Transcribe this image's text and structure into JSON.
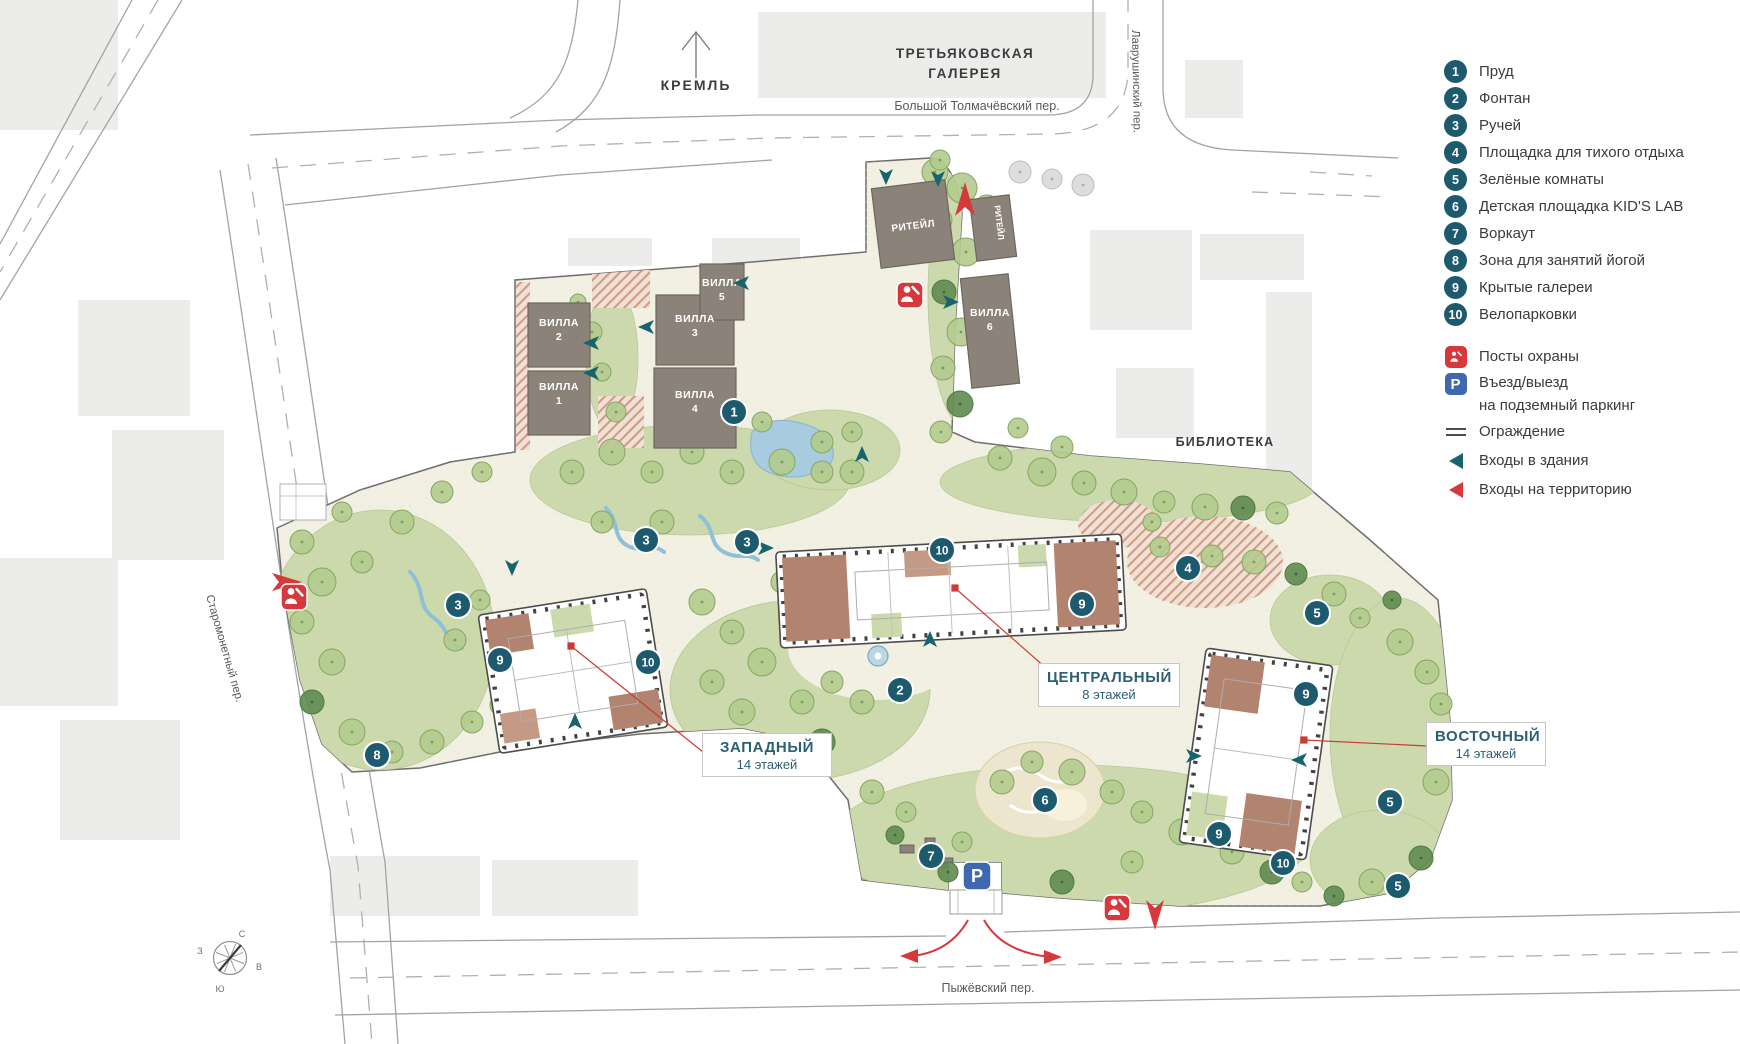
{
  "map": {
    "landmarks": {
      "kremlin": "КРЕМЛЬ",
      "gallery_line1": "ТРЕТЬЯКОВСКАЯ",
      "gallery_line2": "ГАЛЕРЕЯ",
      "library": "БИБЛИОТЕКА"
    },
    "streets": {
      "tolmachevsky": "Большой Толмачёвский пер.",
      "lavrushinsky": "Лаврушинский пер.",
      "staromonetny": "Старомонетный пер.",
      "pyzhevsky": "Пыжёвский пер."
    },
    "villas": [
      {
        "label": "ВИЛЛА 2",
        "x": 559,
        "y": 326
      },
      {
        "label": "ВИЛЛА 1",
        "x": 559,
        "y": 390
      },
      {
        "label": "ВИЛЛА 3",
        "x": 695,
        "y": 322
      },
      {
        "label": "ВИЛЛА 4",
        "x": 695,
        "y": 398
      },
      {
        "label": "ВИЛЛА 5",
        "x": 722,
        "y": 286
      },
      {
        "label": "ВИЛЛА 6",
        "x": 990,
        "y": 316
      }
    ],
    "retail": [
      "РИТЕЙЛ",
      "РИТЕЙЛ"
    ],
    "buildings": [
      {
        "name": "ЗАПАДНЫЙ",
        "floors": "14 этажей"
      },
      {
        "name": "ЦЕНТРАЛЬНЫЙ",
        "floors": "8 этажей"
      },
      {
        "name": "ВОСТОЧНЫЙ",
        "floors": "14 этажей"
      }
    ],
    "markers": [
      {
        "n": "1",
        "x": 734,
        "y": 412
      },
      {
        "n": "2",
        "x": 900,
        "y": 690
      },
      {
        "n": "3",
        "x": 646,
        "y": 540
      },
      {
        "n": "3",
        "x": 747,
        "y": 542
      },
      {
        "n": "3",
        "x": 458,
        "y": 605
      },
      {
        "n": "4",
        "x": 1188,
        "y": 568
      },
      {
        "n": "5",
        "x": 1317,
        "y": 613
      },
      {
        "n": "5",
        "x": 1390,
        "y": 802
      },
      {
        "n": "5",
        "x": 1398,
        "y": 886
      },
      {
        "n": "6",
        "x": 1045,
        "y": 800
      },
      {
        "n": "7",
        "x": 931,
        "y": 856
      },
      {
        "n": "8",
        "x": 377,
        "y": 755
      },
      {
        "n": "9",
        "x": 500,
        "y": 660
      },
      {
        "n": "9",
        "x": 1082,
        "y": 604
      },
      {
        "n": "9",
        "x": 1306,
        "y": 694
      },
      {
        "n": "9",
        "x": 1219,
        "y": 834
      },
      {
        "n": "10",
        "x": 648,
        "y": 662
      },
      {
        "n": "10",
        "x": 942,
        "y": 550
      },
      {
        "n": "10",
        "x": 1283,
        "y": 863
      }
    ],
    "compass": {
      "north": "С",
      "east": "В",
      "south": "Ю",
      "west": "З"
    }
  },
  "legend": {
    "items": [
      {
        "num": "1",
        "label": "Пруд"
      },
      {
        "num": "2",
        "label": "Фонтан"
      },
      {
        "num": "3",
        "label": "Ручей"
      },
      {
        "num": "4",
        "label": "Площадка для тихого отдыха"
      },
      {
        "num": "5",
        "label": "Зелёные комнаты"
      },
      {
        "num": "6",
        "label": "Детская площадка KID'S LAB"
      },
      {
        "num": "7",
        "label": "Воркаут"
      },
      {
        "num": "8",
        "label": "Зона для занятий йогой"
      },
      {
        "num": "9",
        "label": "Крытые галереи"
      },
      {
        "num": "10",
        "label": "Велопарковки"
      }
    ],
    "security": "Посты охраны",
    "parking_line1": "Въезд/выезд",
    "parking_line2": "на подземный паркинг",
    "fence": "Ограждение",
    "building_entries": "Входы в здания",
    "territory_entries": "Входы на территорию"
  },
  "colors": {
    "badge_teal": "#1e5a6e",
    "accent_red": "#d6383b",
    "parking_blue": "#3e69b0",
    "entry_arrow_teal": "#17646d",
    "label_teal": "#2d5f74"
  }
}
